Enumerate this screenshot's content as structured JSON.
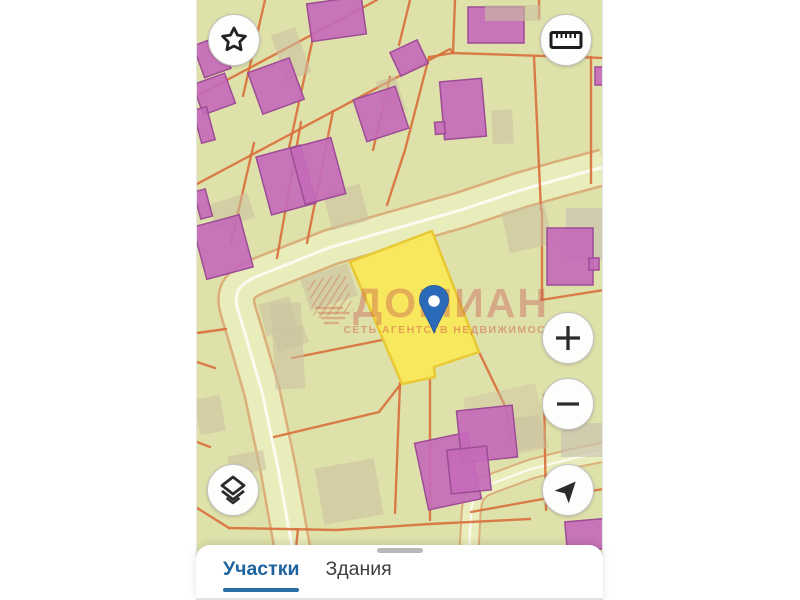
{
  "map": {
    "watermark": {
      "brand": "ДОМИАН",
      "tagline": "СЕТЬ АГЕНТСТВ НЕДВИЖИМОСТИ"
    },
    "selected_plot": {
      "color": "#f9e85a",
      "border": "#e8c934"
    },
    "pin_color": "#2b6ab8",
    "colors": {
      "background": "#dfe1ab",
      "road": "#e9ecbb",
      "road_centerline": "#fbfbef",
      "parcel_line": "#d8703c",
      "building": "#c46ab8",
      "building_border": "#9d4d95",
      "shadow_tan": "#cbbfa0"
    }
  },
  "controls": {
    "favorites_icon": "star",
    "measure_icon": "ruler",
    "zoom_in_icon": "plus",
    "zoom_out_icon": "minus",
    "locate_icon": "navigation-arrow",
    "layers_icon": "layers"
  },
  "bottom_sheet": {
    "tabs": [
      {
        "label": "Участки",
        "active": true
      },
      {
        "label": "Здания",
        "active": false
      }
    ]
  },
  "accent": {
    "tab_active": "#1e639e",
    "tab_inactive": "#3b3f42",
    "underline": "#2a6da6"
  }
}
